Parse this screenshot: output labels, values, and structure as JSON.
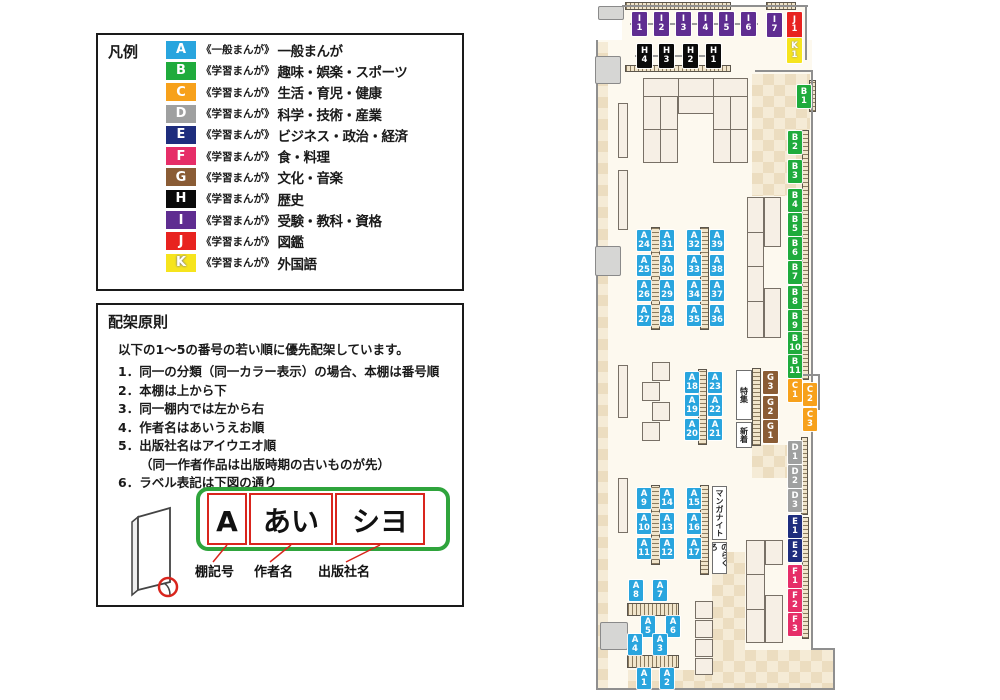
{
  "colors": {
    "A": "#29a5de",
    "B": "#1fab3c",
    "C": "#f7a11b",
    "D": "#9fa0a0",
    "E": "#1e2d7d",
    "F": "#e62e68",
    "G": "#8a5c35",
    "H": "#0a0a0a",
    "I": "#5f2d91",
    "J": "#e8231f",
    "K": "#f6e41d"
  },
  "legend": {
    "title": "凡例",
    "items": [
      {
        "code": "A",
        "type": "《一般まんが》",
        "category": "一般まんが"
      },
      {
        "code": "B",
        "type": "《学習まんが》",
        "category": "趣味・娯楽・スポーツ"
      },
      {
        "code": "C",
        "type": "《学習まんが》",
        "category": "生活・育児・健康"
      },
      {
        "code": "D",
        "type": "《学習まんが》",
        "category": "科学・技術・産業"
      },
      {
        "code": "E",
        "type": "《学習まんが》",
        "category": "ビジネス・政治・経済"
      },
      {
        "code": "F",
        "type": "《学習まんが》",
        "category": "食・料理"
      },
      {
        "code": "G",
        "type": "《学習まんが》",
        "category": "文化・音楽"
      },
      {
        "code": "H",
        "type": "《学習まんが》",
        "category": "歴史"
      },
      {
        "code": "I",
        "type": "《学習まんが》",
        "category": "受験・教科・資格"
      },
      {
        "code": "J",
        "type": "《学習まんが》",
        "category": "図鑑"
      },
      {
        "code": "K",
        "type": "《学習まんが》",
        "category": "外国語"
      }
    ]
  },
  "principles": {
    "title": "配架原則",
    "intro": "以下の1～5の番号の若い順に優先配架しています。",
    "items": [
      {
        "text": "1．同一の分類（同一カラー表示）の場合、本棚は番号順"
      },
      {
        "text": "2．本棚は上から下"
      },
      {
        "text": "3．同一棚内では左から右"
      },
      {
        "text": "4．作者名はあいうえお順"
      },
      {
        "text": "5．出版社名はアイウエオ順",
        "note": "（同一作者作品は出版時期の古いものが先）"
      },
      {
        "text": "6．ラベル表記は下図の通り"
      }
    ]
  },
  "label_diagram": {
    "boxes": [
      "A",
      "あい",
      "シヨ"
    ],
    "captions": [
      "棚記号",
      "作者名",
      "出版社名"
    ]
  },
  "map": {
    "annotations": [
      {
        "text": "特集",
        "x": 736,
        "y": 370,
        "w": 16,
        "h": 50
      },
      {
        "text": "新着",
        "x": 736,
        "y": 422,
        "w": 16,
        "h": 26
      },
      {
        "text": "マンガナイト",
        "x": 712,
        "y": 486,
        "w": 15,
        "h": 54
      },
      {
        "text": "のらくろ",
        "x": 712,
        "y": 542,
        "w": 15,
        "h": 32
      }
    ],
    "labels": [
      {
        "cat": "I",
        "num": "1",
        "x": 632,
        "y": 12,
        "w": 15,
        "h": 24
      },
      {
        "cat": "I",
        "num": "2",
        "x": 654,
        "y": 12,
        "w": 15,
        "h": 24
      },
      {
        "cat": "I",
        "num": "3",
        "x": 676,
        "y": 12,
        "w": 15,
        "h": 24
      },
      {
        "cat": "I",
        "num": "4",
        "x": 698,
        "y": 12,
        "w": 15,
        "h": 24
      },
      {
        "cat": "I",
        "num": "5",
        "x": 719,
        "y": 12,
        "w": 15,
        "h": 24
      },
      {
        "cat": "I",
        "num": "6",
        "x": 741,
        "y": 12,
        "w": 15,
        "h": 24
      },
      {
        "cat": "I",
        "num": "7",
        "x": 767,
        "y": 13,
        "w": 15,
        "h": 24
      },
      {
        "cat": "J",
        "num": "1",
        "x": 787,
        "y": 12,
        "w": 15,
        "h": 26
      },
      {
        "cat": "K",
        "num": "1",
        "x": 787,
        "y": 38,
        "w": 15,
        "h": 25
      },
      {
        "cat": "H",
        "num": "4",
        "x": 637,
        "y": 44,
        "w": 15,
        "h": 24
      },
      {
        "cat": "H",
        "num": "3",
        "x": 659,
        "y": 44,
        "w": 15,
        "h": 24
      },
      {
        "cat": "H",
        "num": "2",
        "x": 683,
        "y": 44,
        "w": 15,
        "h": 24
      },
      {
        "cat": "H",
        "num": "1",
        "x": 706,
        "y": 44,
        "w": 15,
        "h": 24
      },
      {
        "cat": "B",
        "num": "1",
        "x": 797,
        "y": 85,
        "w": 14,
        "h": 23
      },
      {
        "cat": "B",
        "num": "2",
        "x": 788,
        "y": 131,
        "w": 14,
        "h": 23
      },
      {
        "cat": "B",
        "num": "3",
        "x": 788,
        "y": 160,
        "w": 14,
        "h": 23
      },
      {
        "cat": "B",
        "num": "4",
        "x": 788,
        "y": 189,
        "w": 14,
        "h": 23
      },
      {
        "cat": "B",
        "num": "5",
        "x": 788,
        "y": 213,
        "w": 14,
        "h": 23
      },
      {
        "cat": "B",
        "num": "6",
        "x": 788,
        "y": 237,
        "w": 14,
        "h": 23
      },
      {
        "cat": "B",
        "num": "7",
        "x": 788,
        "y": 261,
        "w": 14,
        "h": 23
      },
      {
        "cat": "B",
        "num": "8",
        "x": 788,
        "y": 286,
        "w": 14,
        "h": 23
      },
      {
        "cat": "B",
        "num": "9",
        "x": 788,
        "y": 310,
        "w": 14,
        "h": 23
      },
      {
        "cat": "B",
        "num": "10",
        "x": 788,
        "y": 332,
        "w": 14,
        "h": 23
      },
      {
        "cat": "B",
        "num": "11",
        "x": 788,
        "y": 355,
        "w": 14,
        "h": 23
      },
      {
        "cat": "C",
        "num": "1",
        "x": 788,
        "y": 379,
        "w": 14,
        "h": 23
      },
      {
        "cat": "C",
        "num": "2",
        "x": 803,
        "y": 383,
        "w": 14,
        "h": 23
      },
      {
        "cat": "C",
        "num": "3",
        "x": 803,
        "y": 408,
        "w": 14,
        "h": 23
      },
      {
        "cat": "D",
        "num": "1",
        "x": 788,
        "y": 441,
        "w": 14,
        "h": 23
      },
      {
        "cat": "D",
        "num": "2",
        "x": 788,
        "y": 465,
        "w": 14,
        "h": 23
      },
      {
        "cat": "D",
        "num": "3",
        "x": 788,
        "y": 489,
        "w": 14,
        "h": 23
      },
      {
        "cat": "E",
        "num": "1",
        "x": 788,
        "y": 515,
        "w": 14,
        "h": 23
      },
      {
        "cat": "E",
        "num": "2",
        "x": 788,
        "y": 539,
        "w": 14,
        "h": 23
      },
      {
        "cat": "F",
        "num": "1",
        "x": 788,
        "y": 565,
        "w": 14,
        "h": 23
      },
      {
        "cat": "F",
        "num": "2",
        "x": 788,
        "y": 589,
        "w": 14,
        "h": 23
      },
      {
        "cat": "F",
        "num": "3",
        "x": 788,
        "y": 613,
        "w": 14,
        "h": 23
      },
      {
        "cat": "A",
        "num": "24",
        "x": 637,
        "y": 230,
        "w": 14,
        "h": 21
      },
      {
        "cat": "A",
        "num": "25",
        "x": 637,
        "y": 255,
        "w": 14,
        "h": 21
      },
      {
        "cat": "A",
        "num": "26",
        "x": 637,
        "y": 280,
        "w": 14,
        "h": 21
      },
      {
        "cat": "A",
        "num": "27",
        "x": 637,
        "y": 305,
        "w": 14,
        "h": 21
      },
      {
        "cat": "A",
        "num": "31",
        "x": 660,
        "y": 230,
        "w": 14,
        "h": 21
      },
      {
        "cat": "A",
        "num": "30",
        "x": 660,
        "y": 255,
        "w": 14,
        "h": 21
      },
      {
        "cat": "A",
        "num": "29",
        "x": 660,
        "y": 280,
        "w": 14,
        "h": 21
      },
      {
        "cat": "A",
        "num": "28",
        "x": 660,
        "y": 305,
        "w": 14,
        "h": 21
      },
      {
        "cat": "A",
        "num": "32",
        "x": 687,
        "y": 230,
        "w": 14,
        "h": 21
      },
      {
        "cat": "A",
        "num": "33",
        "x": 687,
        "y": 255,
        "w": 14,
        "h": 21
      },
      {
        "cat": "A",
        "num": "34",
        "x": 687,
        "y": 280,
        "w": 14,
        "h": 21
      },
      {
        "cat": "A",
        "num": "35",
        "x": 687,
        "y": 305,
        "w": 14,
        "h": 21
      },
      {
        "cat": "A",
        "num": "39",
        "x": 710,
        "y": 230,
        "w": 14,
        "h": 21
      },
      {
        "cat": "A",
        "num": "38",
        "x": 710,
        "y": 255,
        "w": 14,
        "h": 21
      },
      {
        "cat": "A",
        "num": "37",
        "x": 710,
        "y": 280,
        "w": 14,
        "h": 21
      },
      {
        "cat": "A",
        "num": "36",
        "x": 710,
        "y": 305,
        "w": 14,
        "h": 21
      },
      {
        "cat": "A",
        "num": "18",
        "x": 685,
        "y": 372,
        "w": 14,
        "h": 21
      },
      {
        "cat": "A",
        "num": "19",
        "x": 685,
        "y": 395,
        "w": 14,
        "h": 21
      },
      {
        "cat": "A",
        "num": "20",
        "x": 685,
        "y": 419,
        "w": 14,
        "h": 21
      },
      {
        "cat": "A",
        "num": "23",
        "x": 708,
        "y": 372,
        "w": 14,
        "h": 21
      },
      {
        "cat": "A",
        "num": "22",
        "x": 708,
        "y": 395,
        "w": 14,
        "h": 21
      },
      {
        "cat": "A",
        "num": "21",
        "x": 708,
        "y": 419,
        "w": 14,
        "h": 21
      },
      {
        "cat": "G",
        "num": "3",
        "x": 763,
        "y": 371,
        "w": 15,
        "h": 23
      },
      {
        "cat": "G",
        "num": "2",
        "x": 763,
        "y": 396,
        "w": 15,
        "h": 23
      },
      {
        "cat": "G",
        "num": "1",
        "x": 763,
        "y": 420,
        "w": 15,
        "h": 23
      },
      {
        "cat": "A",
        "num": "9",
        "x": 637,
        "y": 488,
        "w": 14,
        "h": 21
      },
      {
        "cat": "A",
        "num": "10",
        "x": 637,
        "y": 513,
        "w": 14,
        "h": 21
      },
      {
        "cat": "A",
        "num": "11",
        "x": 637,
        "y": 538,
        "w": 14,
        "h": 21
      },
      {
        "cat": "A",
        "num": "14",
        "x": 660,
        "y": 488,
        "w": 14,
        "h": 21
      },
      {
        "cat": "A",
        "num": "13",
        "x": 660,
        "y": 513,
        "w": 14,
        "h": 21
      },
      {
        "cat": "A",
        "num": "12",
        "x": 660,
        "y": 538,
        "w": 14,
        "h": 21
      },
      {
        "cat": "A",
        "num": "15",
        "x": 687,
        "y": 488,
        "w": 14,
        "h": 21
      },
      {
        "cat": "A",
        "num": "16",
        "x": 687,
        "y": 513,
        "w": 14,
        "h": 21
      },
      {
        "cat": "A",
        "num": "17",
        "x": 687,
        "y": 538,
        "w": 14,
        "h": 21
      },
      {
        "cat": "A",
        "num": "8",
        "x": 629,
        "y": 580,
        "w": 14,
        "h": 21
      },
      {
        "cat": "A",
        "num": "7",
        "x": 653,
        "y": 580,
        "w": 14,
        "h": 21
      },
      {
        "cat": "A",
        "num": "5",
        "x": 641,
        "y": 616,
        "w": 14,
        "h": 21
      },
      {
        "cat": "A",
        "num": "6",
        "x": 666,
        "y": 616,
        "w": 14,
        "h": 21
      },
      {
        "cat": "A",
        "num": "4",
        "x": 628,
        "y": 634,
        "w": 14,
        "h": 21
      },
      {
        "cat": "A",
        "num": "3",
        "x": 653,
        "y": 634,
        "w": 14,
        "h": 21
      },
      {
        "cat": "A",
        "num": "1",
        "x": 637,
        "y": 668,
        "w": 14,
        "h": 21
      },
      {
        "cat": "A",
        "num": "2",
        "x": 660,
        "y": 668,
        "w": 14,
        "h": 21
      }
    ]
  }
}
